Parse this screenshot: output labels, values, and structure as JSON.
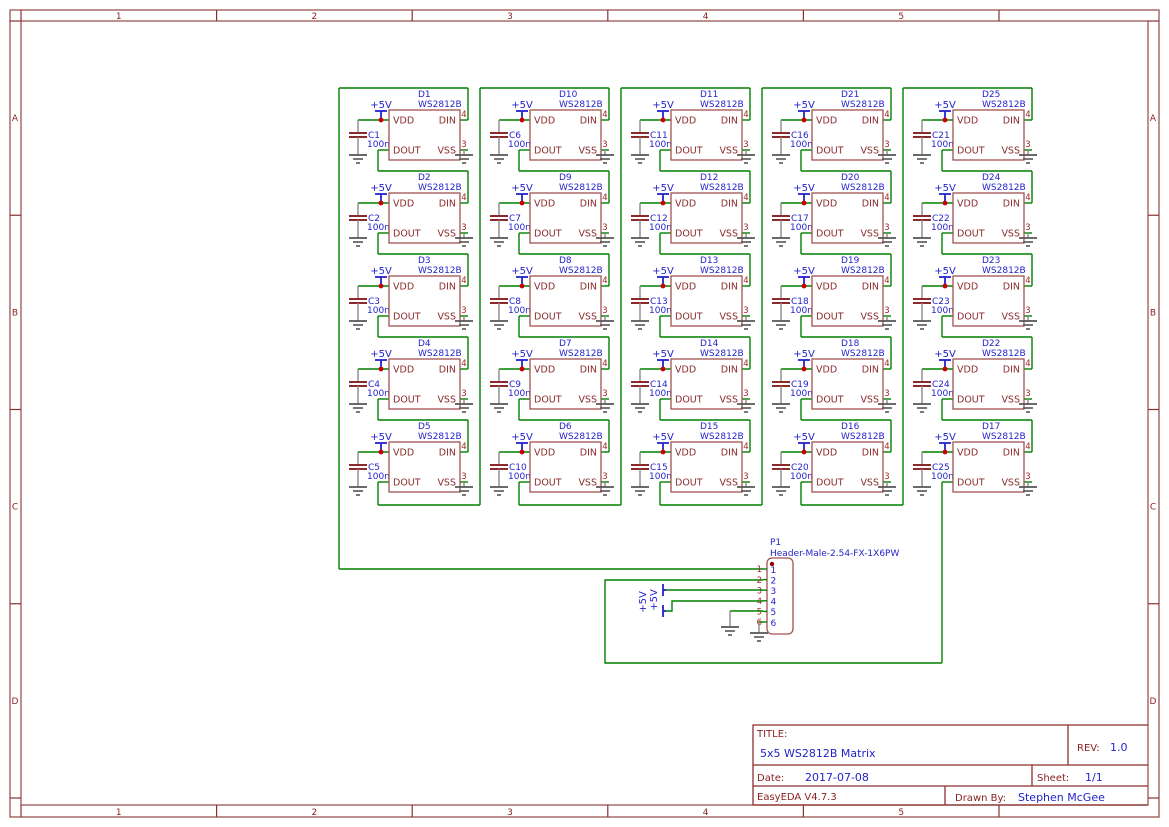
{
  "frame": {
    "cols": [
      "1",
      "2",
      "3",
      "4",
      "5"
    ],
    "rows": [
      "A",
      "B",
      "C",
      "D"
    ]
  },
  "title_block": {
    "title_label": "TITLE:",
    "title": "5x5 WS2812B Matrix",
    "rev_label": "REV:",
    "rev": "1.0",
    "date_label": "Date:",
    "date": "2017-07-08",
    "sheet_label": "Sheet:",
    "sheet": "1/1",
    "tool": "EasyEDA V4.7.3",
    "drawn_by_label": "Drawn By:",
    "drawn_by": "Stephen McGee"
  },
  "matrix": {
    "part": "WS2812B",
    "cap_value": "100nF",
    "power_net": "+5V",
    "pin_vdd": "VDD",
    "pin_din": "DIN",
    "pin_dout": "DOUT",
    "pin_vss": "VSS",
    "pin_num_din": "4",
    "pin_num_vss": "3",
    "cells": [
      {
        "d": "D1",
        "c": "C1"
      },
      {
        "d": "D10",
        "c": "C6"
      },
      {
        "d": "D11",
        "c": "C11"
      },
      {
        "d": "D21",
        "c": "C16"
      },
      {
        "d": "D25",
        "c": "C21"
      },
      {
        "d": "D2",
        "c": "C2"
      },
      {
        "d": "D9",
        "c": "C7"
      },
      {
        "d": "D12",
        "c": "C12"
      },
      {
        "d": "D20",
        "c": "C17"
      },
      {
        "d": "D24",
        "c": "C22"
      },
      {
        "d": "D3",
        "c": "C3"
      },
      {
        "d": "D8",
        "c": "C8"
      },
      {
        "d": "D13",
        "c": "C13"
      },
      {
        "d": "D19",
        "c": "C18"
      },
      {
        "d": "D23",
        "c": "C23"
      },
      {
        "d": "D4",
        "c": "C4"
      },
      {
        "d": "D7",
        "c": "C9"
      },
      {
        "d": "D14",
        "c": "C14"
      },
      {
        "d": "D18",
        "c": "C19"
      },
      {
        "d": "D22",
        "c": "C24"
      },
      {
        "d": "D5",
        "c": "C5"
      },
      {
        "d": "D6",
        "c": "C10"
      },
      {
        "d": "D15",
        "c": "C15"
      },
      {
        "d": "D16",
        "c": "C20"
      },
      {
        "d": "D17",
        "c": "C25"
      }
    ]
  },
  "connector": {
    "ref": "P1",
    "part": "Header-Male-2.54-FX-1X6PW",
    "pins": [
      "1",
      "2",
      "3",
      "4",
      "5",
      "6"
    ],
    "power_net": "+5V"
  },
  "colors": {
    "wire": "#008000",
    "component": "#a05252",
    "component_text": "#8b2a2a",
    "label": "#2323cc",
    "junction": "#cc0000",
    "frame": "#9a5555",
    "frame_text": "#8b2222",
    "ground": "#555555"
  }
}
